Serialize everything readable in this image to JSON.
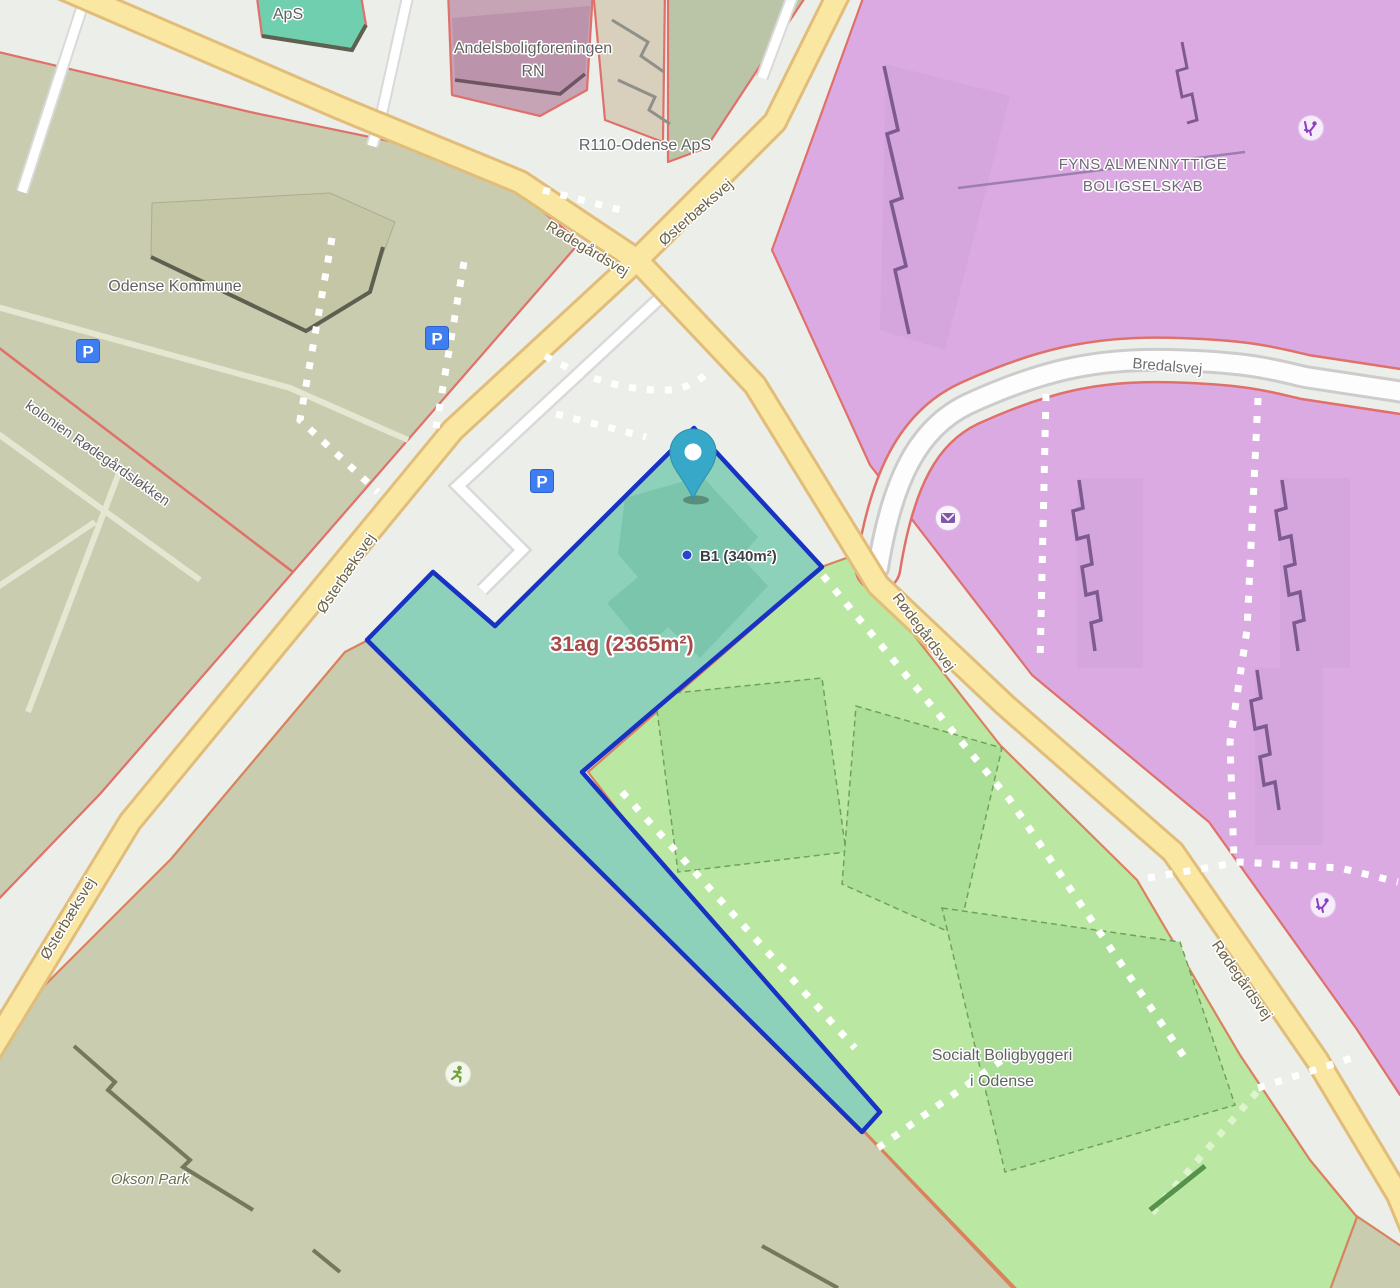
{
  "map": {
    "highlight": {
      "parcel_label": "31ag (2365m²)",
      "building_label": "B1 (340m²)"
    },
    "roads": {
      "rodegardsvej": "Rødegårdsvej",
      "osterbaeksvej": "Østerbæksvej",
      "bredalsvej": "Bredalsvej"
    },
    "places": {
      "aps": "ApS",
      "andelsboligforeningen_line1": "Andelsboligforeningen",
      "andelsboligforeningen_line2": "RN",
      "r110": "R110-Odense ApS",
      "odense_kommune": "Odense Kommune",
      "fyns_line1": "FYNS ALMENNYTTIGE",
      "fyns_line2": "BOLIGSELSKAB",
      "socialt_line1": "Socialt Boligbyggeri",
      "socialt_line2": "i Odense",
      "okson_park": "Okson Park",
      "kolonien": "kolonien Rødegårdsløkken"
    },
    "icons": {
      "parking_letter": "P"
    },
    "colors": {
      "highlight_fill": "#8ed1ba",
      "highlight_border": "#1832c4",
      "residential_purple": "#dcaae2",
      "residential_green": "#bae8a3",
      "area_olive": "#c9ccae",
      "road_yellow": "#f9e7a2",
      "boundary_red": "#e0706a",
      "pin": "#38a8c8"
    }
  }
}
